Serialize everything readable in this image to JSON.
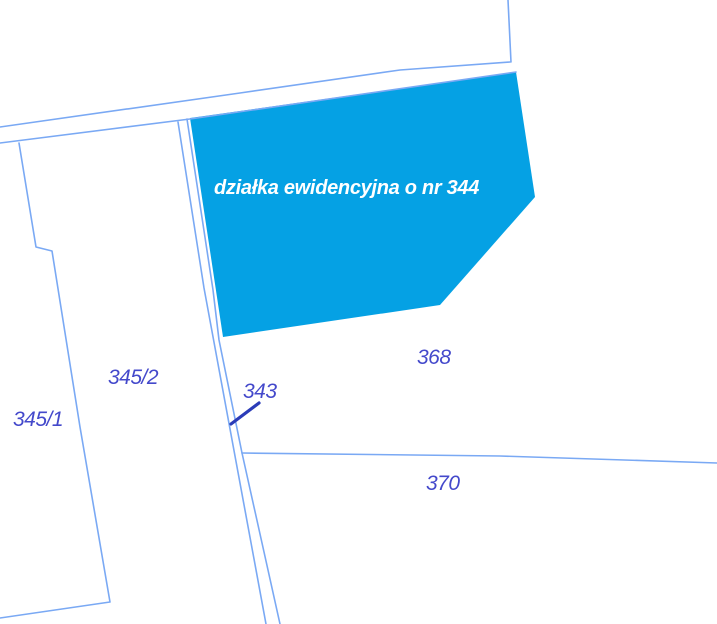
{
  "map": {
    "highlighted_parcel": {
      "id": "344",
      "label": "działka ewidencyjna o nr 344"
    },
    "parcel_labels": [
      {
        "id": "345/2",
        "text": "345/2"
      },
      {
        "id": "345/1",
        "text": "345/1"
      },
      {
        "id": "343",
        "text": "343"
      },
      {
        "id": "368",
        "text": "368"
      },
      {
        "id": "370",
        "text": "370"
      }
    ]
  },
  "colors": {
    "background": "#FFFFFF",
    "boundary_line": "#7AA9F4",
    "highlight_fill": "#05A1E4",
    "highlight_text": "#FFFFFF",
    "label_text": "#4449CB",
    "leader_line": "#2B3CB8"
  }
}
